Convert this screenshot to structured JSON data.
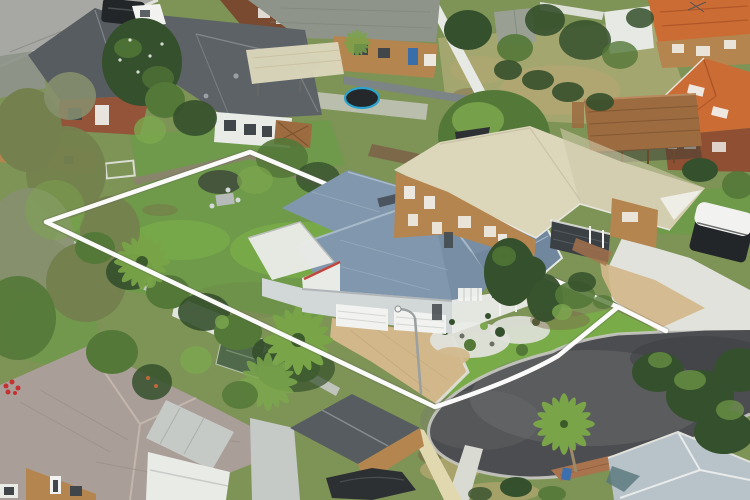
{
  "meta": {
    "title": "Aerial drone photograph of a suburban residential property outlined with a white boundary marker",
    "description": "Bird's-eye real-estate photo: subject house with blue-grey metal roof, white walls and double garage sits inside a white surveyed boundary outline containing a large leafy backyard with palms. The boundary fronts a dark asphalt cul-de-sac at lower right. Neighbouring houses: dark grey tiled roofs upper left, brick cottage with green roof at top, orange terracotta two-storey at upper right, cream-roof brick house to the east, pink-grey tiled roof house lower left, pale blue-grey roof lower right. Lawns, hedges, timber deck, trampoline, sheds, campervan and a street light complete the scene.",
    "type": "aerial-photograph",
    "overlay_label": "property boundary outline"
  },
  "boundary": {
    "label": "white property boundary outline",
    "color": "#ffffff",
    "vertices_px": [
      [
        46,
        222
      ],
      [
        250,
        152
      ],
      [
        618,
        307
      ],
      [
        666,
        331
      ],
      [
        435,
        407
      ]
    ]
  },
  "scene": {
    "areas": [
      "subject-house-blue-roof",
      "subject-backyard-lawn",
      "palm-trees",
      "front-garden-pebbles",
      "paved-driveway",
      "cul-de-sac-road",
      "footpath",
      "street-light",
      "neighbor-house-cream-roof-east",
      "charcoal-garage-door",
      "campervan",
      "house-dark-grey-roof-top-left",
      "brick-cottage-green-roof-top",
      "cream-pergola",
      "trampoline",
      "green-garden-shed",
      "orange-terracotta-house",
      "timber-deck",
      "tiled-roof-house-bottom-left",
      "garage-dark-gable-bottom",
      "boat-tarp",
      "shade-house",
      "blue-grey-roof-house-bottom-right",
      "eucalyptus-trees",
      "magnolia-tree",
      "white-boundary-overlay",
      "black-4wd",
      "white-ute",
      "hedges",
      "fences"
    ]
  },
  "colors": {
    "grass_base": "#7e9356",
    "grass_mid": "#6e9a4a",
    "grass_bright": "#79ab49",
    "grass_pale": "#a9a873",
    "grass_dry": "#b3a671",
    "road": "#4b4d50",
    "road_worn": "#707274",
    "road_dark": "#3e4043",
    "road_top": "#a7a8a4",
    "kerb": "#c9c9c3",
    "concrete": "#e1e2dc",
    "path": "#d9dad2",
    "paver_tan": "#d2b78a",
    "paver_brick": "#a9734e",
    "roof_dark": "#575c60",
    "roof_dark2": "#5d6266",
    "roof_blue": "#8097ad",
    "roof_blue_dark": "#71879d",
    "roof_blue_light": "#adbecd",
    "roof_cream": "#dcd6bb",
    "roof_cream_dark": "#cfc8aa",
    "roof_orange": "#cc6c35",
    "roof_orange_dark": "#a85224",
    "roof_tile_brown": "#aa9e98",
    "tile_ridge": "#c2b6ad",
    "roof_grey_green": "#8e948a",
    "roof_pale": "#c6cac6",
    "roof_br": "#b7c2c9",
    "teal_roof": "#57777c",
    "shed": "#99a093",
    "wall_white": "#e9ebe7",
    "wall_grey": "#d2d7d8",
    "brick_warm": "#b5854f",
    "brick_red": "#93543a",
    "brick_dark": "#8e4f33",
    "fence_white": "#e7e9e5",
    "fence_grey": "#7d8486",
    "fence_light": "#c4c8c4",
    "fence_cream": "#e2d8b0",
    "fence_brown": "#8d8171",
    "deck": "#9c6b40",
    "deck_dark": "#7e5530",
    "garage_dark": "#3b4044",
    "tree_dark": "#35502c",
    "tree_mid": "#547838",
    "tree_light": "#7ca74d",
    "tree_olive": "#74814e",
    "tree_grey": "#87906f",
    "palm": "#79a447",
    "soil": "#7c6549",
    "tarp": "#2d3032",
    "van_dark": "#232629",
    "white": "#f2f3f0",
    "boundary": "#ffffff",
    "trampoline": "#2aa3cf",
    "window_dark": "#41464b",
    "door_blue": "#3a6ea8",
    "bin_blue": "#3c6fad",
    "shadehouse": "#50694a",
    "red_trim": "#c0473d",
    "flower_red": "#c53030",
    "ridge_light": "#8b9094",
    "trunk": "#9c8a6a",
    "metal_grey": "#9aa0a0"
  }
}
